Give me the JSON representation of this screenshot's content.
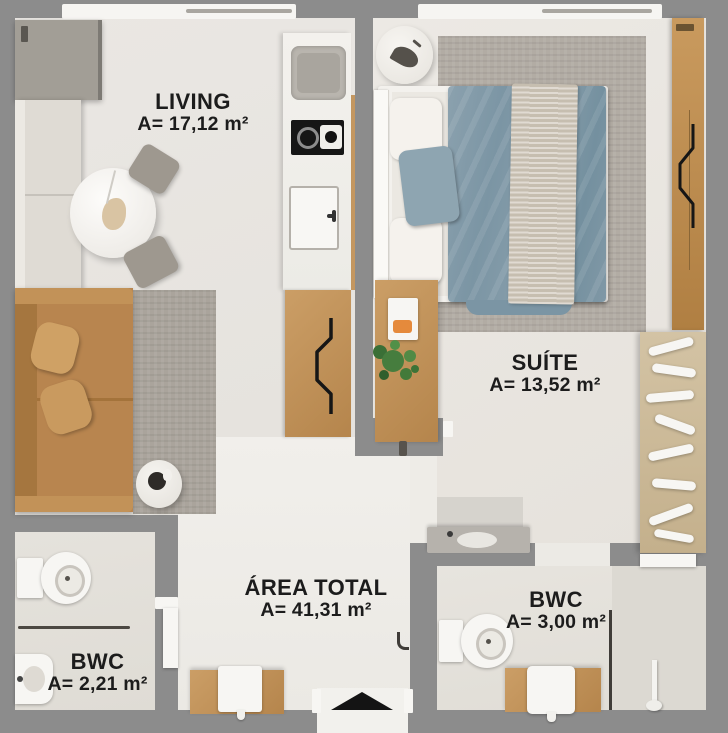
{
  "title": "Apartment floor plan",
  "rooms": [
    {
      "id": "living",
      "name": "LIVING",
      "area": "A= 17,12 m²"
    },
    {
      "id": "suite",
      "name": "SUÍTE",
      "area": "A= 13,52 m²"
    },
    {
      "id": "area-total",
      "name": "ÁREA TOTAL",
      "area": "A= 41,31 m²"
    },
    {
      "id": "bwc-left",
      "name": "BWC",
      "area": "A= 2,21 m²"
    },
    {
      "id": "bwc-right",
      "name": "BWC",
      "area": "A= 3,00 m²"
    }
  ],
  "icons": {
    "entrance_arrow": "triangle-up"
  },
  "colors": {
    "wall": "#8c8c8c",
    "floor_living": "#e9e6e2",
    "floor_suite": "#ebe8e3",
    "floor_hall": "#f0eeea",
    "wood": "#c79a63",
    "sofa_caramel": "#b8854f",
    "sofa_white": "#dfdbd4",
    "bed_blue": "#7f99a7",
    "blanket_beige": "#cfc7ba",
    "rug": "#aba59d",
    "label_text": "#1c1c1c"
  }
}
